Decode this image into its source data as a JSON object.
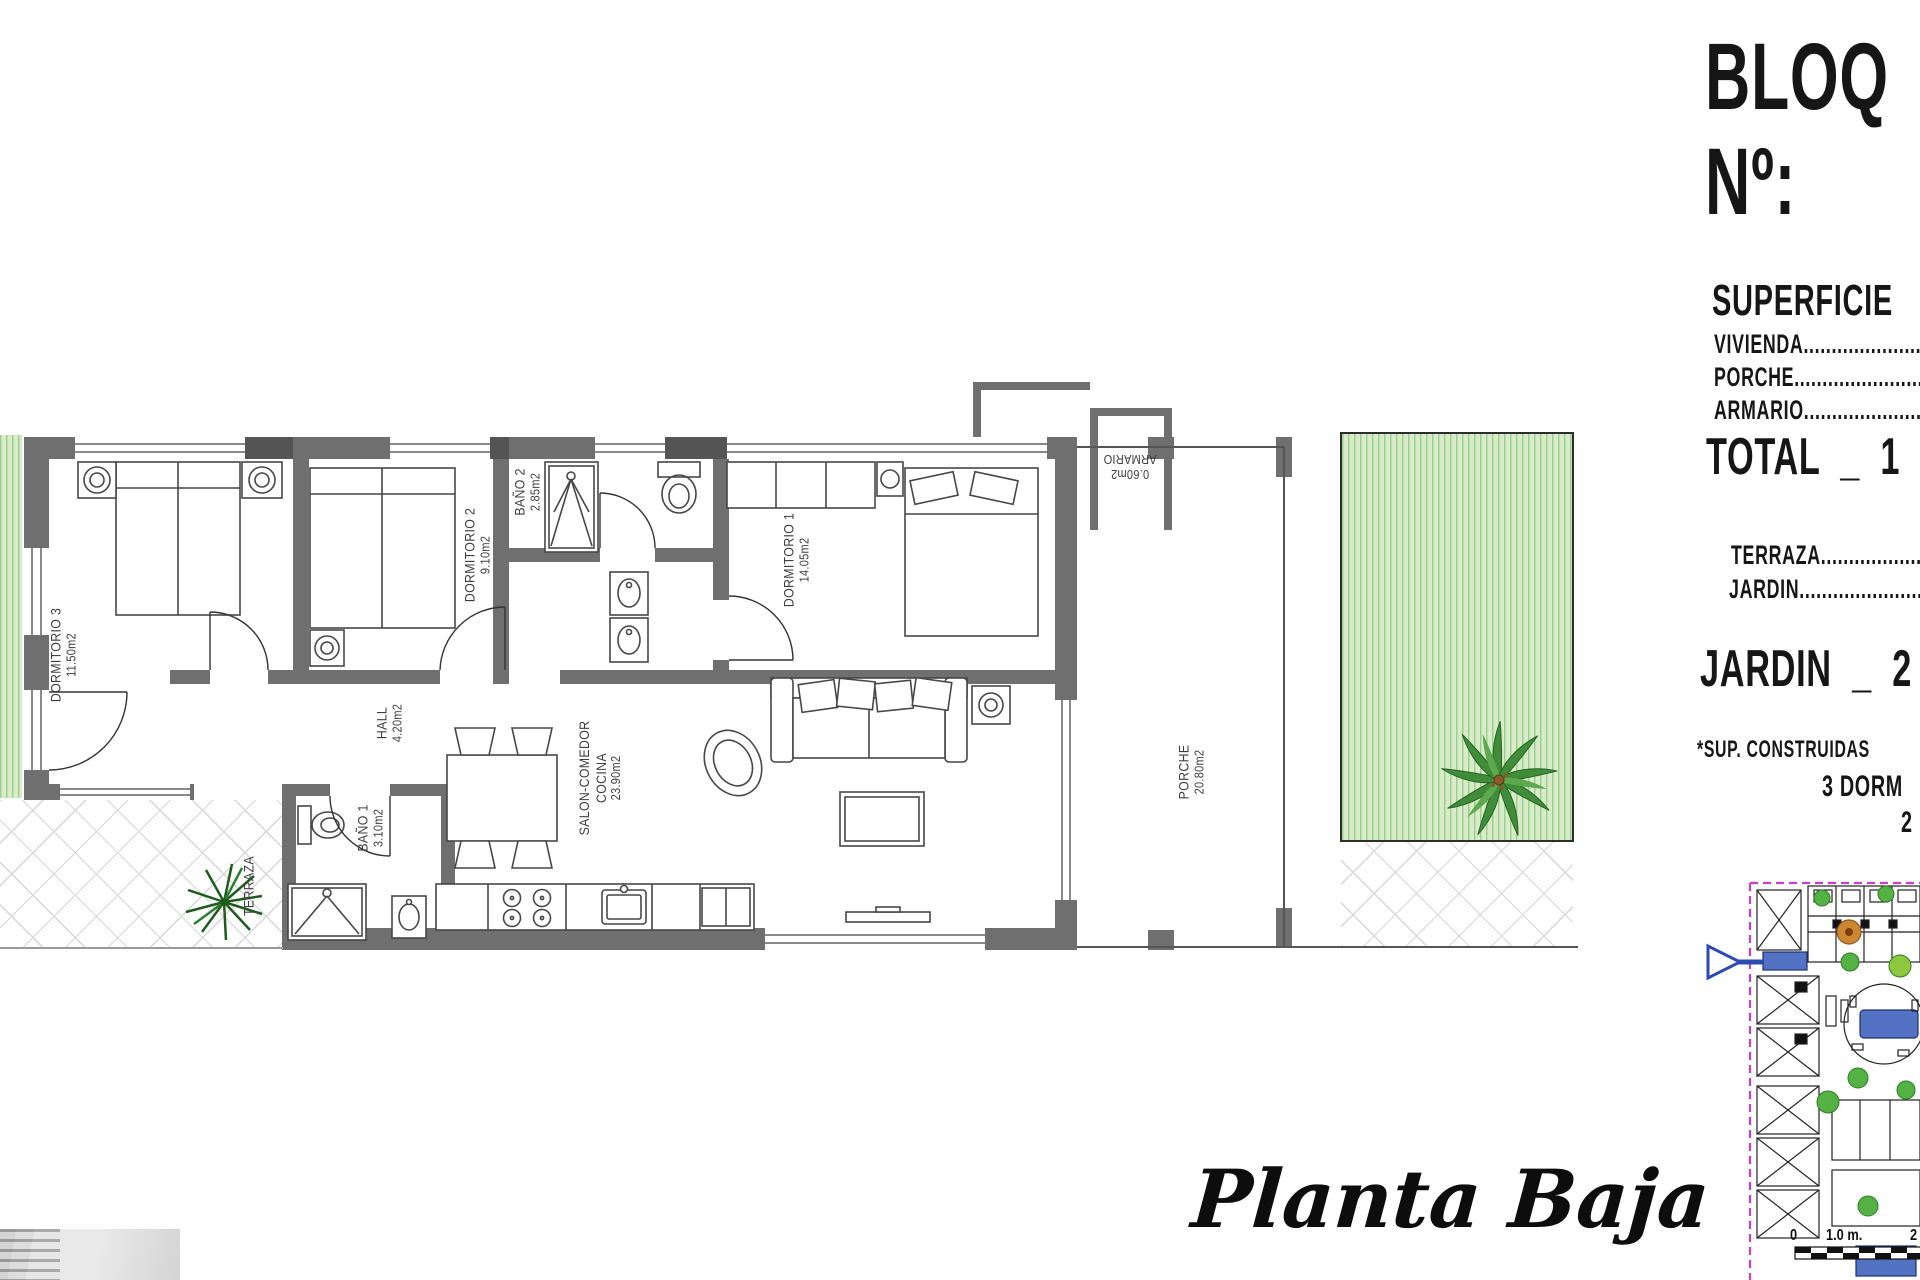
{
  "panel": {
    "bloque": "BLOQ",
    "numero": "Nº:",
    "superficie_heading": "SUPERFICIE",
    "vivienda": "VIVIENDA",
    "porche": "PORCHE",
    "armario": "ARMARIO",
    "dots": "........................................",
    "total": "TOTAL  _  1",
    "terraza": "TERRAZA",
    "jardin": "JARDIN",
    "jardin_total": "JARDIN  _  2",
    "sup_note": "*SUP. CONSTRUIDAS",
    "dorm_note": "3 DORM",
    "banos_note": "2"
  },
  "rooms": {
    "dormitorio3": {
      "name": "DORMITORIO 3",
      "area": "11.50m2"
    },
    "dormitorio2": {
      "name": "DORMITORIO 2",
      "area": "9.10m2"
    },
    "bano2": {
      "name": "BAÑO 2",
      "area": "2.85m2"
    },
    "dormitorio1": {
      "name": "DORMITORIO 1",
      "area": "14.05m2"
    },
    "hall": {
      "name": "HALL",
      "area": "4.20m2"
    },
    "bano1": {
      "name": "BAÑO 1",
      "area": "3.10m2"
    },
    "salon": {
      "name": "SALON-COMEDOR",
      "name2": "COCINA",
      "area": "23.90m2"
    },
    "porche": {
      "name": "PORCHE",
      "area": "20.80m2"
    },
    "terraza": {
      "name": "TERRAZA"
    },
    "armario": {
      "name": "ARMARIO",
      "area": "0.60m2"
    }
  },
  "title": {
    "script": "Planta Baja"
  },
  "scalebar": {
    "n0": "0",
    "n1": "1.0 m.",
    "n2": "2"
  },
  "colors": {
    "wall": "#6f6f6f",
    "accent_blue": "#5472c4",
    "boundary_magenta": "#c93fc9",
    "garden_green": "#9ecf90"
  }
}
